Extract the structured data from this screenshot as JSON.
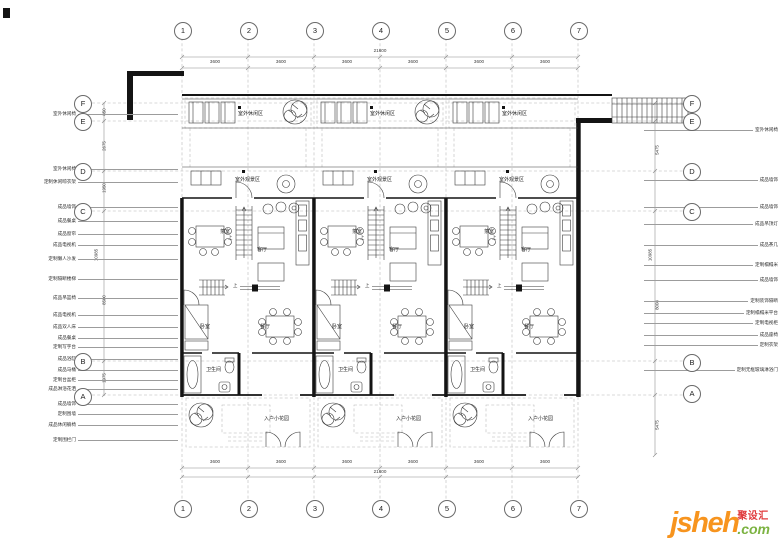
{
  "watermark": {
    "brand": "jsheh",
    "domain": ".com",
    "cn": "聚设汇"
  },
  "colors": {
    "brand_orange": "#F7941E",
    "brand_green": "#7CB342",
    "brand_red": "#E03A3C",
    "wall": "#141414",
    "line": "#3c3c3c"
  },
  "grid": {
    "columns": [
      "1",
      "2",
      "3",
      "4",
      "5",
      "6",
      "7"
    ],
    "rows": [
      "F",
      "E",
      "D",
      "C",
      "B",
      "A"
    ]
  },
  "dims": {
    "total": "21600",
    "bays": [
      {
        "x": 215,
        "v": "3600"
      },
      {
        "x": 281,
        "v": "3600"
      },
      {
        "x": 347,
        "v": "3600"
      },
      {
        "x": 413,
        "v": "3600"
      },
      {
        "x": 479,
        "v": "3600"
      },
      {
        "x": 545,
        "v": "3600"
      }
    ],
    "left": [
      {
        "x": 104,
        "y": 112,
        "v": "850"
      },
      {
        "x": 104,
        "y": 146,
        "v": "2675"
      },
      {
        "x": 104,
        "y": 188,
        "v": "1950"
      },
      {
        "x": 96,
        "y": 255,
        "v": "10985"
      },
      {
        "x": 104,
        "y": 300,
        "v": "8500"
      },
      {
        "x": 104,
        "y": 378,
        "v": "1975"
      }
    ],
    "right": [
      {
        "x": 657,
        "y": 150,
        "v": "5475"
      },
      {
        "x": 650,
        "y": 255,
        "v": "10985"
      },
      {
        "x": 657,
        "y": 305,
        "v": "8008"
      },
      {
        "x": 657,
        "y": 425,
        "v": "5475"
      }
    ]
  },
  "annotations": {
    "left": [
      {
        "y": 111,
        "text": "室外休闲椅"
      },
      {
        "y": 166,
        "text": "室外休闲椅"
      },
      {
        "y": 179,
        "text": "定制休闲晾衣架"
      },
      {
        "y": 204,
        "text": "成品墙饰"
      },
      {
        "y": 218,
        "text": "成品餐桌"
      },
      {
        "y": 231,
        "text": "成品窗帘"
      },
      {
        "y": 242,
        "text": "成品电视机"
      },
      {
        "y": 256,
        "text": "定制懒人沙发"
      },
      {
        "y": 276,
        "text": "定制隔断楼梯"
      },
      {
        "y": 295,
        "text": "成品吊篮椅"
      },
      {
        "y": 312,
        "text": "成品电视机"
      },
      {
        "y": 324,
        "text": "成品双人床"
      },
      {
        "y": 335,
        "text": "成品餐桌"
      },
      {
        "y": 344,
        "text": "定制写字台"
      },
      {
        "y": 356,
        "text": "成品浴缸"
      },
      {
        "y": 367,
        "text": "成品马桶"
      },
      {
        "y": 377,
        "text": "定制台盆柜"
      },
      {
        "y": 386,
        "text": "成品淋浴花洒"
      },
      {
        "y": 401,
        "text": "成品墙饰"
      },
      {
        "y": 411,
        "text": "定制围墙"
      },
      {
        "y": 422,
        "text": "成品休闲躺椅"
      },
      {
        "y": 437,
        "text": "定制围栏门"
      }
    ],
    "right": [
      {
        "y": 127,
        "text": "室外休闲椅"
      },
      {
        "y": 177,
        "text": "成品墙饰"
      },
      {
        "y": 204,
        "text": "成品墙饰"
      },
      {
        "y": 221,
        "text": "成品吊顶灯"
      },
      {
        "y": 242,
        "text": "成品茶几"
      },
      {
        "y": 262,
        "text": "定制榻榻米"
      },
      {
        "y": 277,
        "text": "成品墙饰"
      },
      {
        "y": 298,
        "text": "定制装饰隔断"
      },
      {
        "y": 310,
        "text": "定制榻榻米平台"
      },
      {
        "y": 320,
        "text": "定制电视柜"
      },
      {
        "y": 332,
        "text": "成品座椅"
      },
      {
        "y": 342,
        "text": "定制衣架"
      },
      {
        "y": 367,
        "text": "定制无框玻璃淋浴门"
      }
    ]
  },
  "rooms": {
    "outdoor_leisure": "室外休闲区",
    "outdoor_view": "室外观景区",
    "tea": "茶室",
    "living": "客厅",
    "bedroom": "卧室",
    "dining": "餐厅",
    "bath": "卫生间",
    "garden": "入户小花园",
    "up": "上"
  }
}
